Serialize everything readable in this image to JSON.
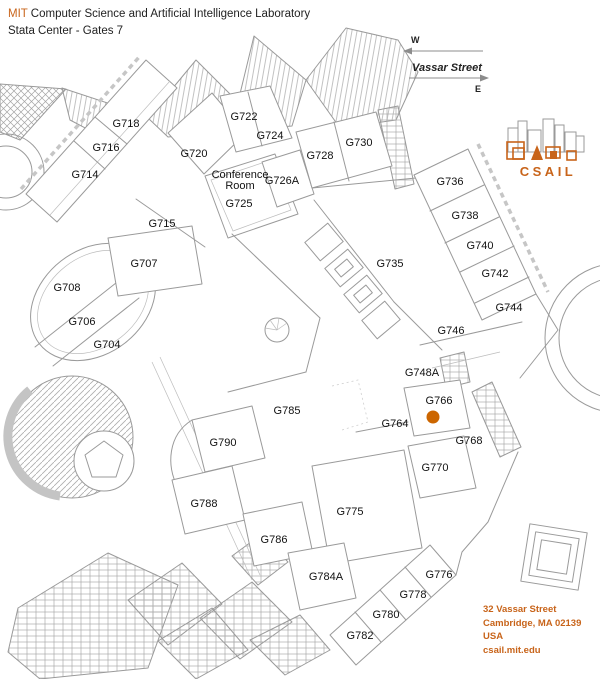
{
  "header": {
    "brand": "MIT",
    "title": "Computer Science and Artificial Intelligence Laboratory",
    "subtitle": "Stata Center - Gates 7"
  },
  "street_sign": {
    "name": "Vassar Street",
    "west_label": "W",
    "east_label": "E"
  },
  "logo": {
    "wordmark": "CSAIL"
  },
  "address": {
    "lines": [
      "32 Vassar Street",
      "Cambridge, MA 02139",
      "USA",
      "csail.mit.edu"
    ]
  },
  "colors": {
    "accent": "#C8641A",
    "plan_line": "#9a9a9a",
    "label_text": "#111111",
    "marker": "#CC6600"
  },
  "map": {
    "marker": {
      "room": "G766",
      "x": 433,
      "y": 417,
      "r": 6.5
    },
    "rooms": [
      {
        "label": "G718",
        "x": 126,
        "y": 123
      },
      {
        "label": "G716",
        "x": 106,
        "y": 147
      },
      {
        "label": "G714",
        "x": 85,
        "y": 174
      },
      {
        "label": "G720",
        "x": 194,
        "y": 153
      },
      {
        "label": "G722",
        "x": 244,
        "y": 116
      },
      {
        "label": "G724",
        "x": 270,
        "y": 135
      },
      {
        "lines": [
          "Conference",
          "Room"
        ],
        "x": 240,
        "y": 174,
        "size": 9.5
      },
      {
        "label": "G725",
        "x": 239,
        "y": 203
      },
      {
        "label": "G726A",
        "x": 282,
        "y": 180
      },
      {
        "label": "G715",
        "x": 162,
        "y": 223
      },
      {
        "label": "G707",
        "x": 144,
        "y": 263
      },
      {
        "label": "G708",
        "x": 67,
        "y": 287
      },
      {
        "label": "G706",
        "x": 82,
        "y": 321
      },
      {
        "label": "G704",
        "x": 107,
        "y": 344
      },
      {
        "label": "G728",
        "x": 320,
        "y": 155
      },
      {
        "label": "G730",
        "x": 359,
        "y": 142
      },
      {
        "label": "G735",
        "x": 390,
        "y": 263
      },
      {
        "label": "G736",
        "x": 450,
        "y": 181
      },
      {
        "label": "G738",
        "x": 465,
        "y": 215
      },
      {
        "label": "G740",
        "x": 480,
        "y": 245
      },
      {
        "label": "G742",
        "x": 495,
        "y": 273
      },
      {
        "label": "G744",
        "x": 509,
        "y": 307
      },
      {
        "label": "G746",
        "x": 451,
        "y": 330
      },
      {
        "label": "G748A",
        "x": 422,
        "y": 372
      },
      {
        "label": "G766",
        "x": 439,
        "y": 400
      },
      {
        "label": "G764",
        "x": 395,
        "y": 423
      },
      {
        "label": "G768",
        "x": 469,
        "y": 440
      },
      {
        "label": "G770",
        "x": 435,
        "y": 467
      },
      {
        "label": "G785",
        "x": 287,
        "y": 410
      },
      {
        "label": "G790",
        "x": 223,
        "y": 442
      },
      {
        "label": "G788",
        "x": 204,
        "y": 503
      },
      {
        "label": "G786",
        "x": 274,
        "y": 539
      },
      {
        "label": "G775",
        "x": 350,
        "y": 511
      },
      {
        "label": "G784A",
        "x": 326,
        "y": 576
      },
      {
        "label": "G776",
        "x": 439,
        "y": 574
      },
      {
        "label": "G778",
        "x": 413,
        "y": 594
      },
      {
        "label": "G780",
        "x": 386,
        "y": 614
      },
      {
        "label": "G782",
        "x": 360,
        "y": 635
      }
    ]
  }
}
